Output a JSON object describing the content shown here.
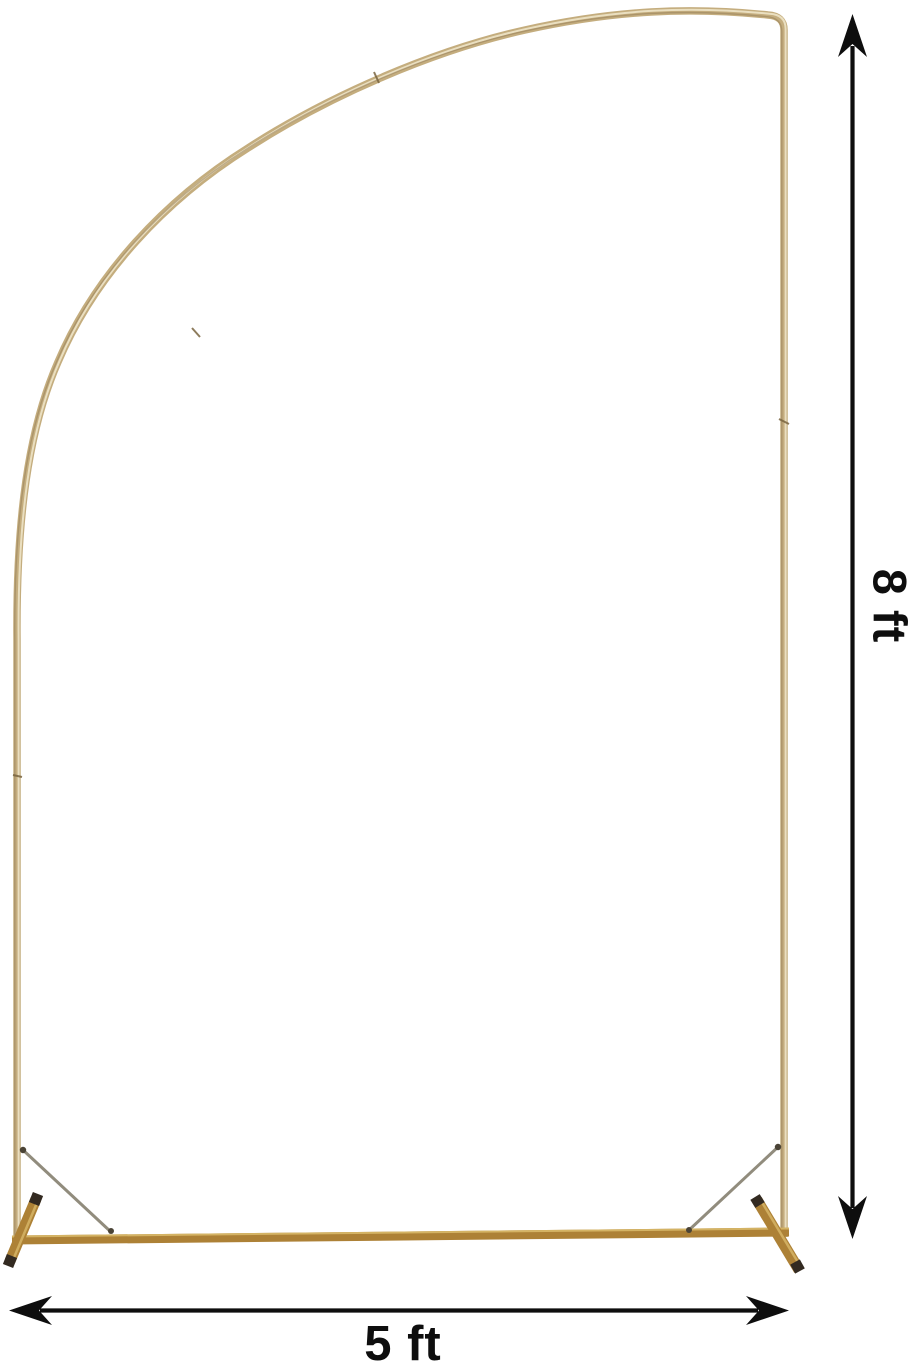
{
  "image": {
    "kind": "product-dimension-diagram",
    "subject": "gold half-arch backdrop stand frame"
  },
  "dimensions": {
    "height": {
      "label": "8 ft"
    },
    "width": {
      "label": "5 ft"
    }
  },
  "annotations": {
    "height_arrow_icon": "double-arrow-vertical",
    "width_arrow_icon": "double-arrow-horizontal"
  },
  "colors": {
    "background": "#ffffff",
    "frame_gold": "#c4ad7e",
    "frame_gold_highlight": "#eee4c8",
    "frame_gold_dark": "#ad8136",
    "base_highlight": "#d9b96a",
    "foot_cap": "#332a21",
    "brace": "#918c7d",
    "joint": "#7a6540",
    "annotation": "#0e0e0e"
  }
}
